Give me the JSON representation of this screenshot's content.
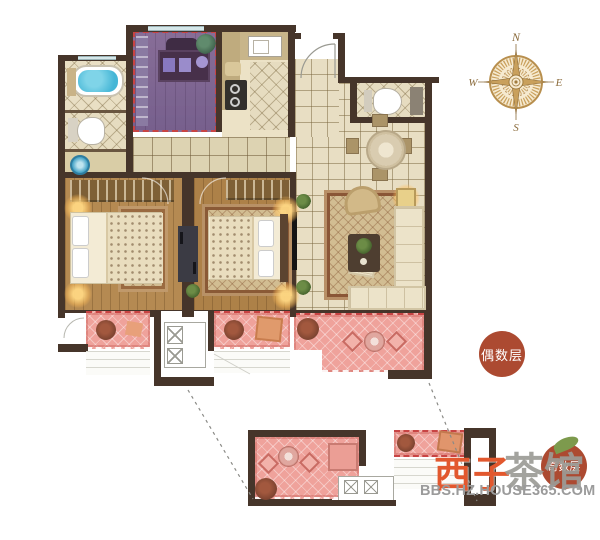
{
  "compass": {
    "n": "N",
    "e": "E",
    "s": "S",
    "w": "W"
  },
  "badges": {
    "even_floor": "偶数层",
    "odd_floor": "奇数层"
  },
  "watermark": {
    "brand_left": "西子",
    "brand_right": "茶馆",
    "site": "BBS.HZ.HOUSE365.COM"
  },
  "colors": {
    "wall": "#46352a",
    "floor_tile": "#e8dec3",
    "wood": "#b58a52",
    "balcony_pink": "#efa29b",
    "highlight_purple": "#8d7ca8",
    "water_blue": "#45b6d6",
    "badge_red": "#ac4a31",
    "compass_gold": "#b88f4e",
    "wm_orange": "#e2582e",
    "wm_gray": "#9c9c96",
    "glow": "#f7c97e",
    "sofa_cream": "#ece3c9",
    "rug_brown": "#8a5636",
    "dark_divider": "#3b3b44",
    "dashed_red": "#c84444"
  }
}
